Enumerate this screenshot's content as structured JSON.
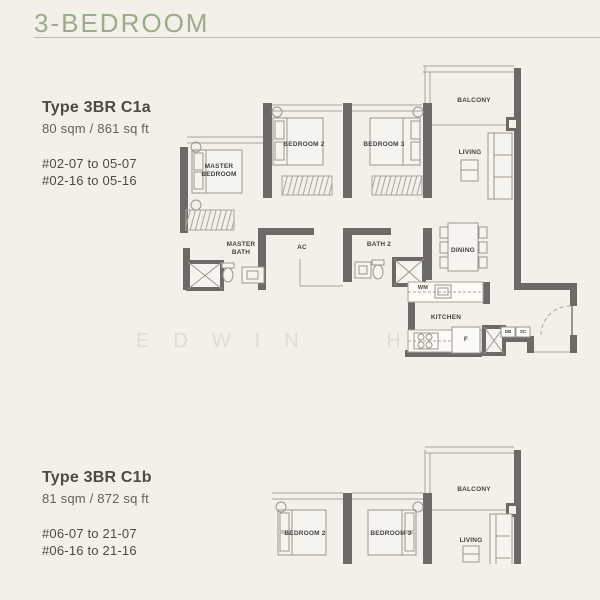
{
  "page": {
    "title": "3-BEDROOM",
    "watermark": "EDWIN HO"
  },
  "colors": {
    "accent": "#9dab8b",
    "wall": "#6b6a66",
    "background": "#f2f0e9"
  },
  "units": [
    {
      "type_label": "Type 3BR C1a",
      "area": "80 sqm / 861 sq ft",
      "stack_line1": "#02-07 to 05-07",
      "stack_line2": "#02-16 to 05-16"
    },
    {
      "type_label": "Type 3BR C1b",
      "area": "81 sqm / 872 sq ft",
      "stack_line1": "#06-07 to 21-07",
      "stack_line2": "#06-16 to 21-16"
    }
  ],
  "plan1": {
    "labels": {
      "master_bedroom": "MASTER\nBEDROOM",
      "bedroom2": "BEDROOM 2",
      "bedroom3": "BEDROOM 3",
      "balcony": "BALCONY",
      "living": "LIVING",
      "dining": "DINING",
      "kitchen": "KITCHEN",
      "master_bath": "MASTER\nBATH",
      "bath2": "BATH 2",
      "ac": "AC",
      "wm": "WM",
      "fridge": "F",
      "db": "DB",
      "sc": "SC"
    }
  },
  "plan2": {
    "labels": {
      "bedroom2": "BEDROOM 2",
      "bedroom3": "BEDROOM 3",
      "balcony": "BALCONY",
      "living": "LIVING"
    }
  }
}
